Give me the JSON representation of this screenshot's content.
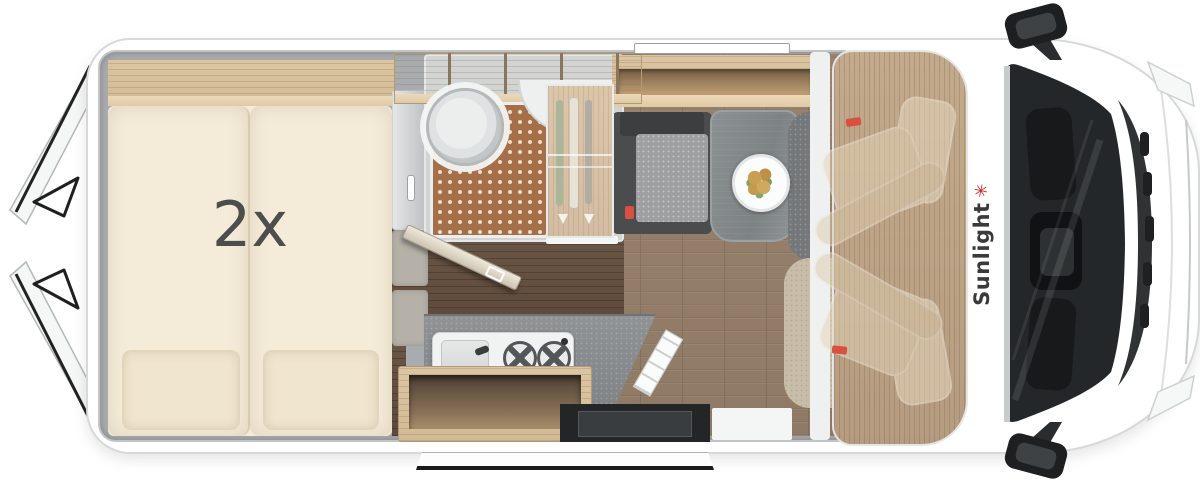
{
  "brand": {
    "name": "Sunlight",
    "palm_glyph": "✳"
  },
  "bed": {
    "capacity_label": "2x"
  },
  "palette": {
    "outline_grey": "#d6d8d9",
    "wall_grey": "#a9acae",
    "wood_light": "#dcc5a2",
    "wood_edge": "#ecd9b8",
    "wood_mid": "#c4aa8c",
    "wood_dark": "#6b5746",
    "floor_living": "#98826d",
    "bed_cream": "#f4ebd9",
    "pillow_cream": "#f0e5cf",
    "cushion_grey": "#b5b1a9",
    "bath_grey": "#d2d3d3",
    "shower_brown": "#a46f49",
    "shower_dot": "#f1e0c8",
    "bench_dark": "#4a4c4e",
    "bench_cushion": "#9d9fa1",
    "table_grey": "#868b8e",
    "counter_grey": "#8f9395",
    "appliance_white": "#f1f2f2",
    "glass_dark": "#24272a",
    "trim_black": "#1d1f20",
    "logo_red": "#cc2b24",
    "logo_text": "#3a3a3a",
    "belt_red": "#d8503f"
  }
}
